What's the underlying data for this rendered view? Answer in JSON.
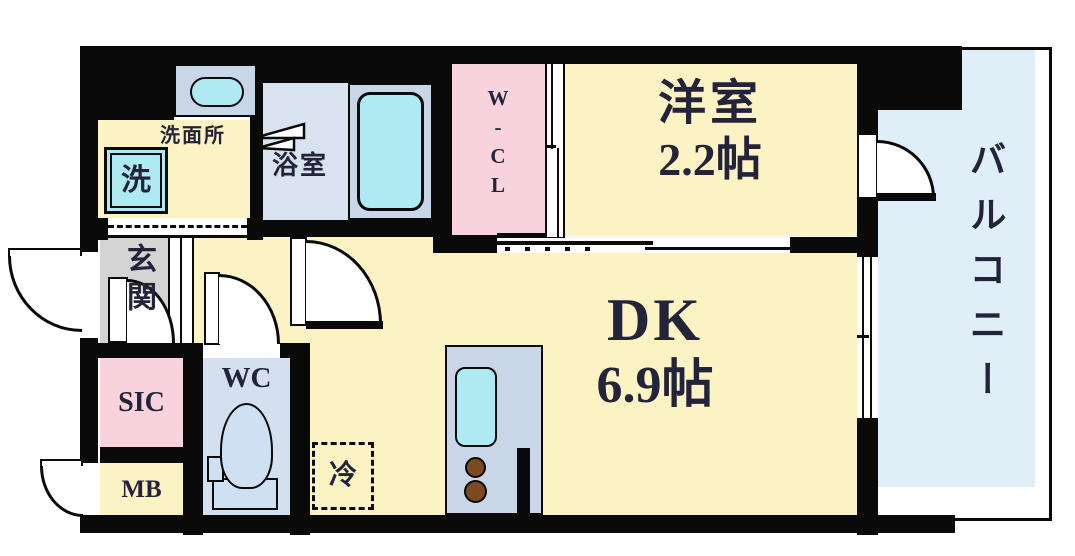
{
  "rooms": {
    "washroom": {
      "label": "洗面所"
    },
    "washer": {
      "label": "洗"
    },
    "bathroom": {
      "label": "浴室"
    },
    "walk_in_closet": {
      "label": "W-CL"
    },
    "western_room": {
      "label": "洋室",
      "size": "2.2帖"
    },
    "balcony": {
      "label": "バルコニー"
    },
    "dining_kitchen": {
      "label": "DK",
      "size": "6.9帖"
    },
    "entrance": {
      "label": "玄関"
    },
    "shoe_closet": {
      "label": "SIC"
    },
    "meter_box": {
      "label": "MB"
    },
    "toilet": {
      "label": "WC"
    },
    "refrigerator_space": {
      "label": "冷"
    }
  },
  "colors": {
    "room_yellow": "#FBF3C4",
    "closet_pink": "#F8D3DE",
    "bath_floor_blue": "#D9E3F0",
    "wc_floor_blue": "#D4E0F0",
    "balcony_blue": "#E0EEF8",
    "fixture_cyan": "#AFE9F2",
    "counter_blue_gray": "#C9D6E8",
    "entrance_gray": "#D4D4D4",
    "wall_black": "#0a0a0a"
  }
}
